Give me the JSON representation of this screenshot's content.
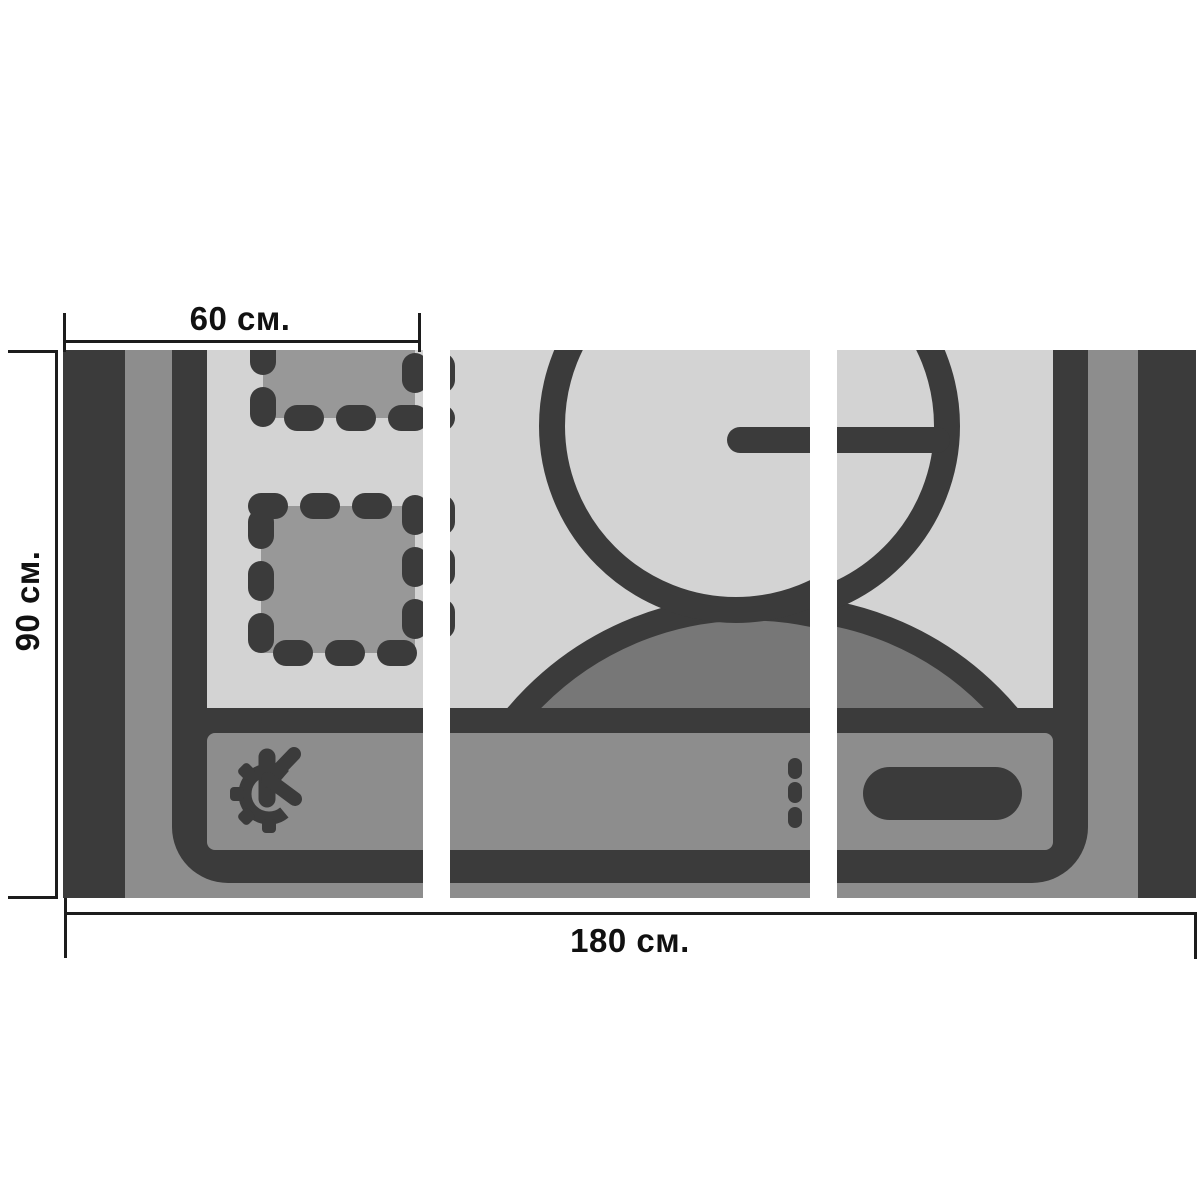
{
  "scene": {
    "kind": "modular-triptych-picture-mockup",
    "panel_count": 3,
    "artwork_subject": "KDE desktop icon with user silhouette, clock hand, dashed widgets and taskbar"
  },
  "annotations": {
    "top": {
      "label": "60 см."
    },
    "left": {
      "label": "90 см."
    },
    "bottom": {
      "label": "180 см."
    }
  },
  "palette": {
    "background": "#ffffff",
    "dark": "#3b3b3b",
    "frame_gray": "#8d8d8d",
    "taskbar_gray": "#8d8d8d",
    "dome_gray": "#777777",
    "widget_gray": "#989898",
    "screen_light": "#d3d3d3",
    "dimension_line": "#1c1c1c",
    "text": "#111111"
  },
  "icons": [
    "kde-gear-logo-icon",
    "user-silhouette-icon",
    "clock-hand-icon",
    "dashed-widget-icon",
    "taskbar-button-pill",
    "taskbar-separator-dots"
  ]
}
